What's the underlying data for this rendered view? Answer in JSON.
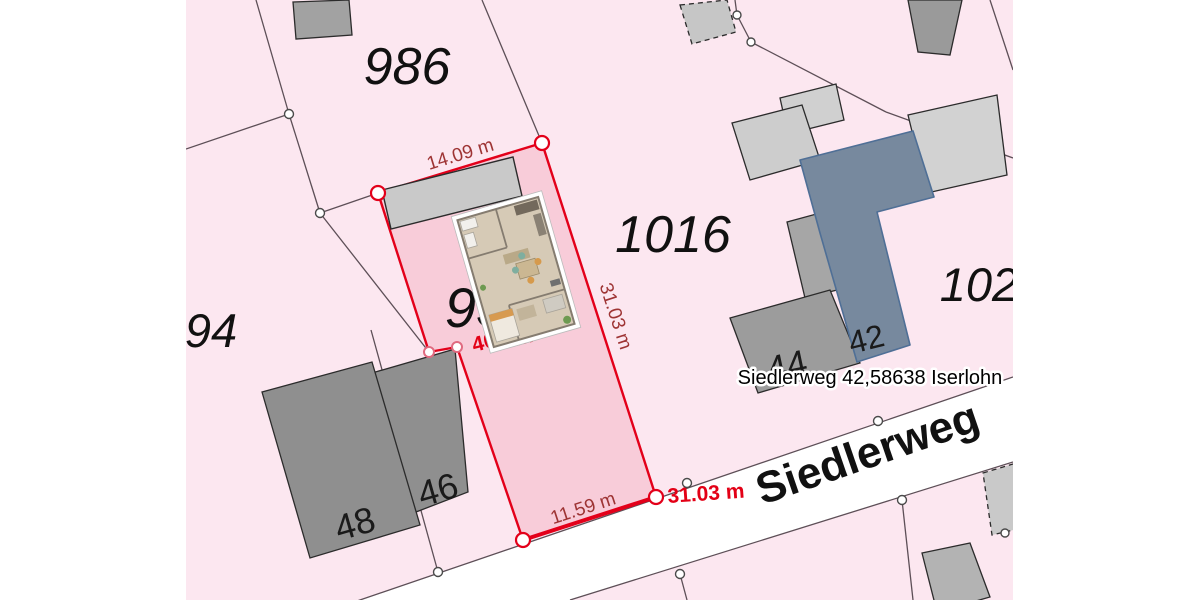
{
  "map": {
    "parcels": {
      "p986": "986",
      "p1016": "1016",
      "p94": "94",
      "p102": "102",
      "p93": "93"
    },
    "dimensions": {
      "top": "14.09 m",
      "side": "31.03 m",
      "bottom": "11.59 m",
      "highlight": "31.03 m"
    },
    "area_label": {
      "prefix": "40",
      "suffix": "m²"
    },
    "house_numbers": {
      "h48": "48",
      "h46": "46",
      "h44": "44",
      "h42": "42"
    },
    "street": {
      "name": "Siedlerweg"
    },
    "address_tooltip": "Siedlerweg 42,58638 Iserlohn",
    "colors": {
      "background_pink": "#fce7f0",
      "selected_parcel_fill": "#f8ccd9",
      "selected_parcel_stroke": "#e3001a",
      "dimension_text": "#9e3434",
      "highlight_red_text": "#e30016",
      "street_fill": "#ffffff",
      "boundary_line": "#5d4f57",
      "building_gray_light": "#d2d2d2",
      "building_gray_mid": "#a6a6a6",
      "building_gray_dark": "#8f8f8f",
      "building_blue_fill": "#77899e",
      "building_blue_stroke": "#4f6f96"
    }
  }
}
